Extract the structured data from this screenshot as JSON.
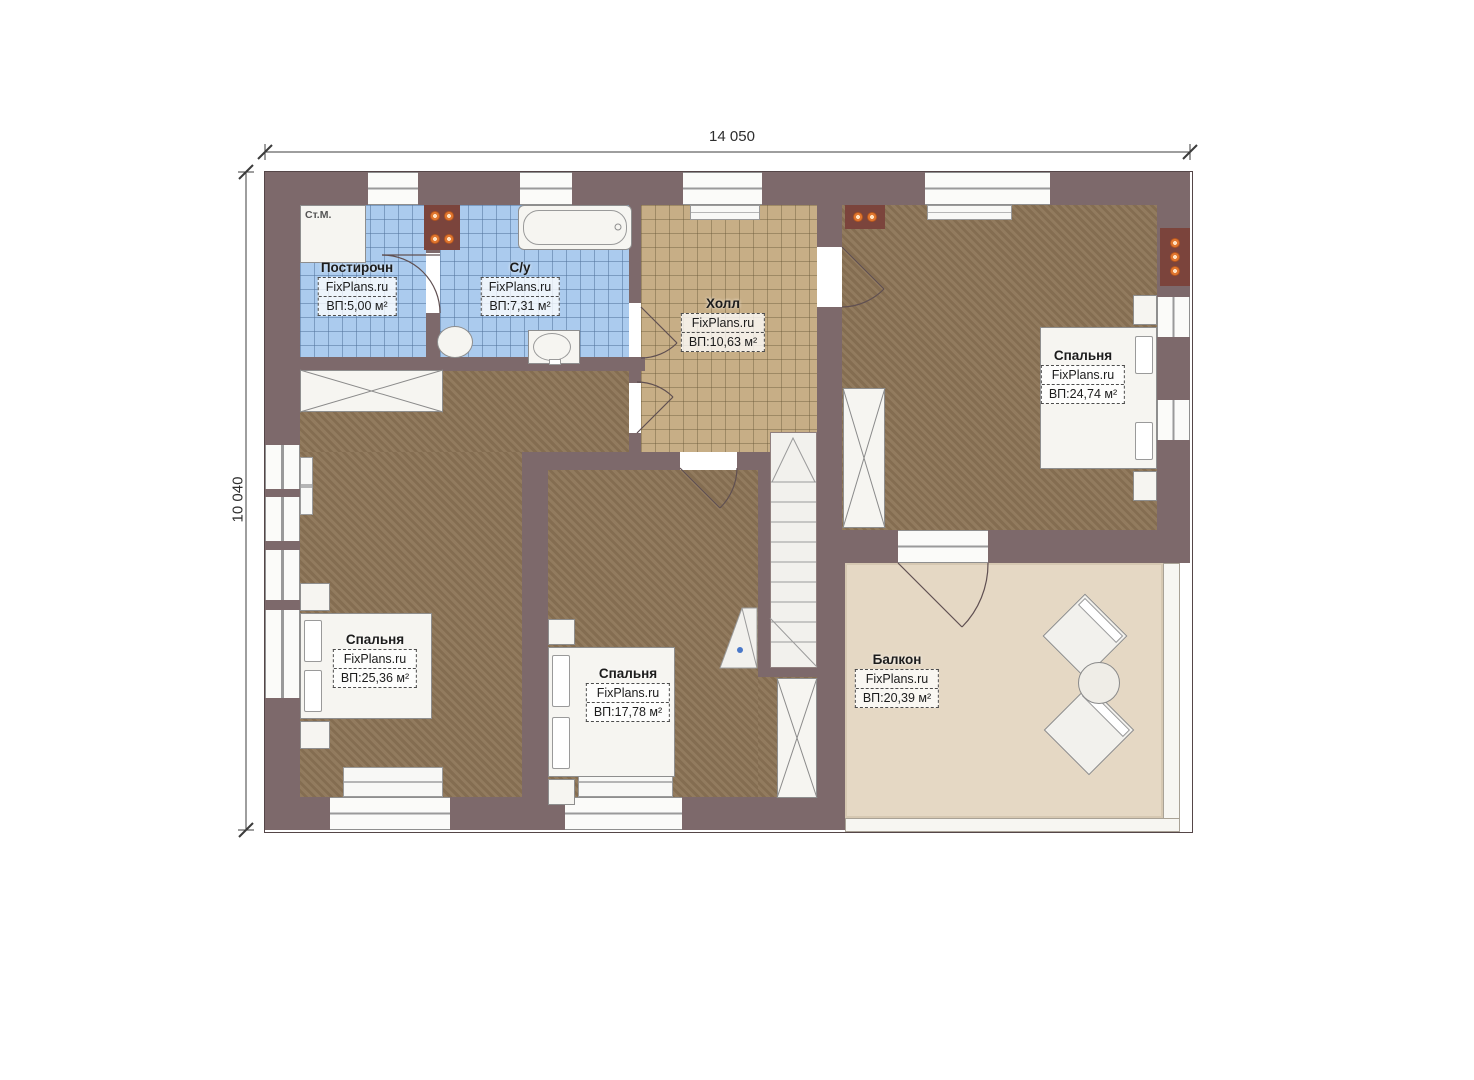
{
  "page": {
    "background": "#ffffff",
    "type": "floor-plan"
  },
  "dimensions": {
    "width": "14 050",
    "height": "10 040"
  },
  "rooms": [
    {
      "id": "laundry",
      "name": "Постирочн",
      "watermark": "FixPlans.ru",
      "area": "ВП:5,00 м²"
    },
    {
      "id": "bathroom",
      "name": "С/у",
      "watermark": "FixPlans.ru",
      "area": "ВП:7,31 м²"
    },
    {
      "id": "hall",
      "name": "Холл",
      "watermark": "FixPlans.ru",
      "area": "ВП:10,63 м²"
    },
    {
      "id": "bedroom-top-right",
      "name": "Спальня",
      "watermark": "FixPlans.ru",
      "area": "ВП:24,74 м²"
    },
    {
      "id": "bedroom-left",
      "name": "Спальня",
      "watermark": "FixPlans.ru",
      "area": "ВП:25,36 м²"
    },
    {
      "id": "bedroom-middle",
      "name": "Спальня",
      "watermark": "FixPlans.ru",
      "area": "ВП:17,78 м²"
    },
    {
      "id": "balcony",
      "name": "Балкон",
      "watermark": "FixPlans.ru",
      "area": "ВП:20,39 м²"
    }
  ],
  "labels": {
    "washing_machine": "Ст.М."
  },
  "colors": {
    "wall": "#7d696b",
    "tile_blue": "#abcbee",
    "wood_floor": "#8c7456",
    "hall_tile": "#c7ae86",
    "balcony_floor": "#e5d8c4",
    "fixture_orange": "#e0762f"
  }
}
